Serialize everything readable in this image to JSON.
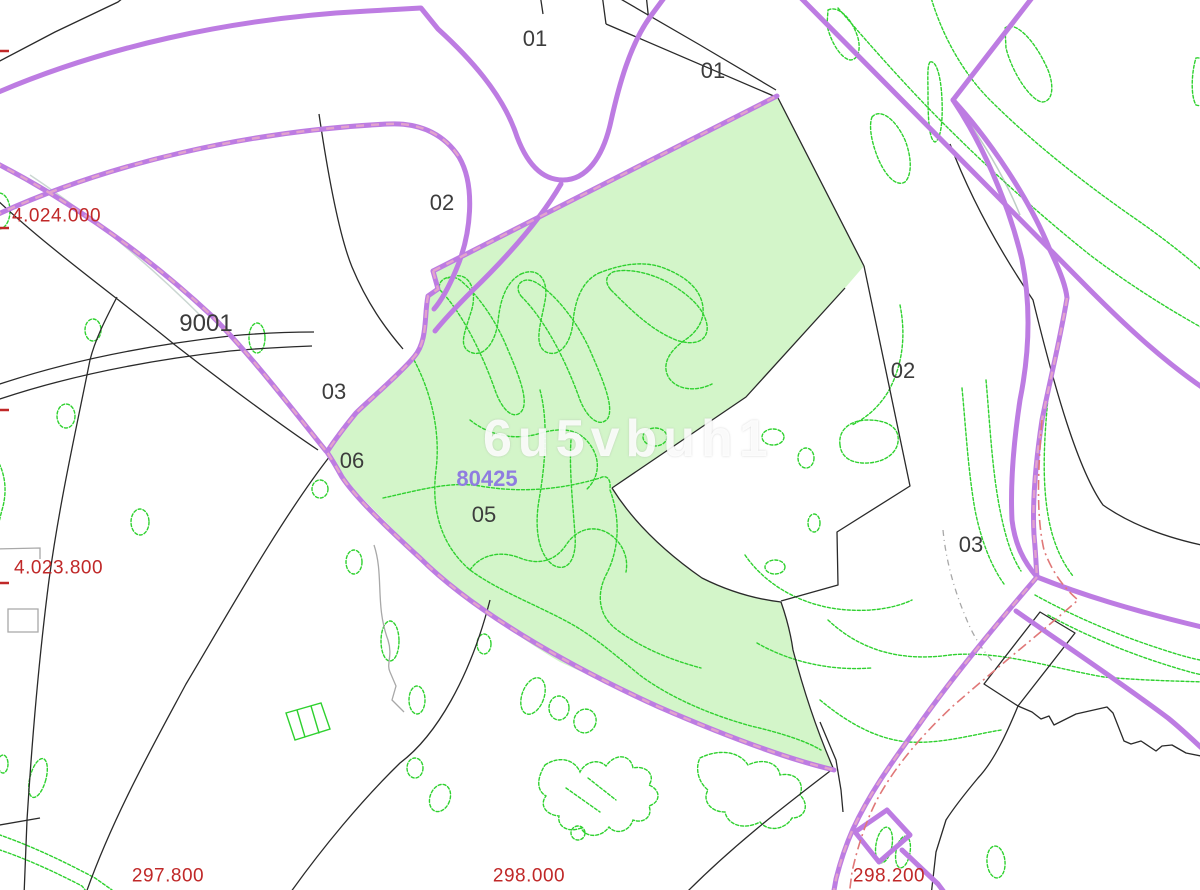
{
  "map": {
    "watermark": "6u5vbuh1",
    "labels": {
      "parcel_01_top": "01",
      "parcel_01_right": "01",
      "parcel_02_top": "02",
      "parcel_02_right": "02",
      "parcel_03_left": "03",
      "parcel_03_right": "03",
      "parcel_05": "05",
      "parcel_06": "06",
      "parcel_road_9001": "9001"
    },
    "highlighted_parcel": {
      "code": "80425"
    },
    "grid": {
      "northings": [
        "4.024.000",
        "4.023.800"
      ],
      "eastings": [
        "297.800",
        "298.000",
        "298.200"
      ]
    },
    "colors": {
      "road_purple": "#bd7ce2",
      "boundary_pink": "#e2a3cd",
      "boundary_salmon": "#e07878",
      "contour_green": "#2fd12f",
      "parcel_fill": "#d3f5c9",
      "line_black": "#2a2a2a",
      "line_gray": "#a8a8a8",
      "shadow_teal": "#7e9c8e",
      "label_red": "#c02828",
      "label_black": "#3c3c3c",
      "highlight_purple": "#8f7ce0"
    }
  }
}
